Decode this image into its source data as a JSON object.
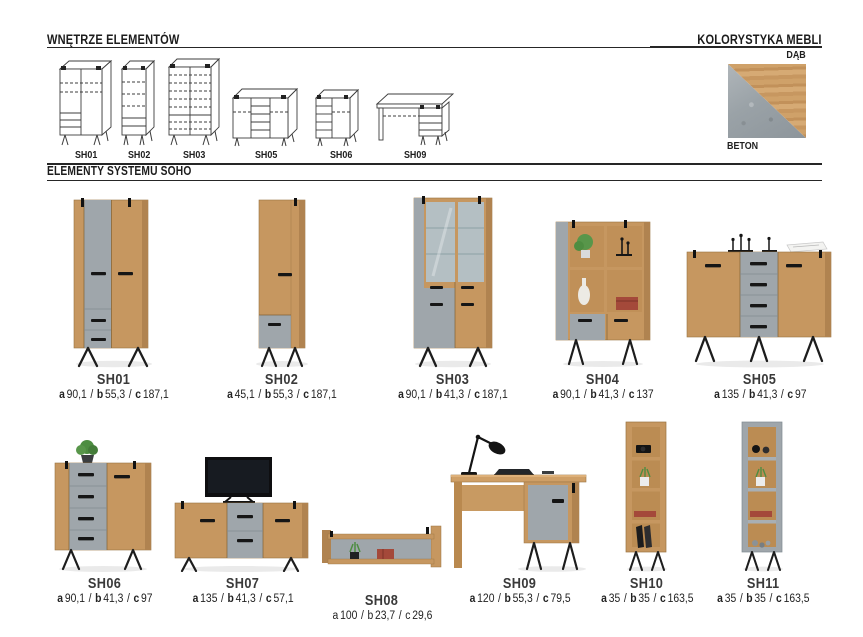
{
  "header": {
    "left_title": "WNĘTRZE ELEMENTÓW",
    "right_title": "KOLORYSTYKA MEBLI"
  },
  "section_title": "ELEMENTY SYSTEMU SOHO",
  "colors_panel": {
    "oak_label": "DĄB",
    "concrete_label": "BETON",
    "oak_color": "#c79760",
    "concrete_color": "#9fa6ab"
  },
  "interior_drawings": [
    {
      "label": "SH01"
    },
    {
      "label": "SH02"
    },
    {
      "label": "SH03"
    },
    {
      "label": "SH05"
    },
    {
      "label": "SH06"
    },
    {
      "label": "SH09"
    }
  ],
  "dim_labels": {
    "a": "a",
    "b": "b",
    "c": "c",
    "sep": "/"
  },
  "products": [
    {
      "name": "SH01",
      "a": "90,1",
      "b": "55,3",
      "c": "187,1"
    },
    {
      "name": "SH02",
      "a": "45,1",
      "b": "55,3",
      "c": "187,1"
    },
    {
      "name": "SH03",
      "a": "90,1",
      "b": "41,3",
      "c": "187,1"
    },
    {
      "name": "SH04",
      "a": "90,1",
      "b": "41,3",
      "c": "137"
    },
    {
      "name": "SH05",
      "a": "135",
      "b": "41,3",
      "c": "97"
    },
    {
      "name": "SH06",
      "a": "90,1",
      "b": "41,3",
      "c": "97"
    },
    {
      "name": "SH07",
      "a": "135",
      "b": "41,3",
      "c": "57,1"
    },
    {
      "name": "SH08",
      "a": "100",
      "b": "23,7",
      "c": "29,6"
    },
    {
      "name": "SH09",
      "a": "120",
      "b": "55,3",
      "c": "79,5"
    },
    {
      "name": "SH10",
      "a": "35",
      "b": "35",
      "c": "163,5"
    },
    {
      "name": "SH11",
      "a": "35",
      "b": "35",
      "c": "163,5"
    }
  ]
}
